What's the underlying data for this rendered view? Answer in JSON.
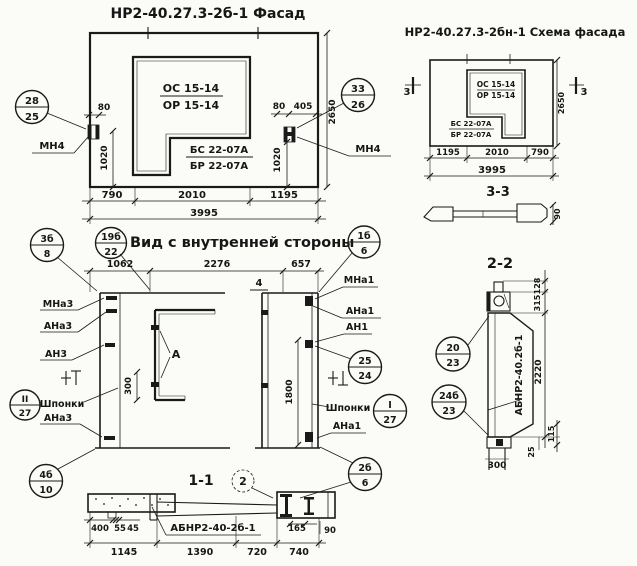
{
  "facade": {
    "title": "НР2-40.27.3-2б-1 Фасад",
    "window_mark": {
      "top": "ОС 15-14",
      "bottom": "ОР 15-14"
    },
    "panel_mark": {
      "top": "БС 22-07А",
      "bottom": "БР 22-07А"
    },
    "anchor_left": "МН4",
    "anchor_right": "МН4",
    "callout_left": {
      "top": "28",
      "bottom": "25"
    },
    "callout_right": {
      "top": "33",
      "bottom": "26"
    },
    "dims": {
      "w80_left": "80",
      "w80_right": "80",
      "w405": "405",
      "h1020_left": "1020",
      "h1020_right": "1020",
      "h2650": "2650",
      "b790": "790",
      "b2010": "2010",
      "b1195": "1195",
      "total": "3995"
    }
  },
  "schema": {
    "title": "НР2-40.27.3-2бн-1 Схема фасада",
    "window_mark": {
      "top": "ОС 15-14",
      "bottom": "ОР 15-14"
    },
    "panel_mark": {
      "top": "БС 22-07А",
      "bottom": "БР 22-07А"
    },
    "section_mark_left": "3",
    "section_mark_right": "3",
    "section_label": "3-3",
    "profile_dim": "90",
    "dims": {
      "b1195": "1195",
      "b2010": "2010",
      "b790": "790",
      "total": "3995",
      "h2650": "2650"
    }
  },
  "inner_view": {
    "title": "Вид с внутренней стороны",
    "detail_label": "А",
    "section_mark_4": "4",
    "dims": {
      "t1062": "1062",
      "t2276": "2276",
      "t657": "657",
      "v300": "300",
      "v1800": "1800"
    },
    "labels_left": {
      "mna3": "МНа3",
      "ana3_top": "АНа3",
      "an3": "АН3",
      "shponki": "Шпонки",
      "ana3_bottom": "АНа3"
    },
    "labels_right": {
      "mna1": "МНа1",
      "ana1_top": "АНа1",
      "an1": "АН1",
      "shponki": "Шпонки",
      "ana1_bottom": "АНа1"
    },
    "callouts": {
      "c3b8": {
        "top": "3б",
        "bottom": "8"
      },
      "c19b22": {
        "top": "19б",
        "bottom": "22"
      },
      "c1b6": {
        "top": "1б",
        "bottom": "6"
      },
      "c2524": {
        "top": "25",
        "bottom": "24"
      },
      "cI27": {
        "top": "I",
        "bottom": "27"
      },
      "cII27": {
        "top": "II",
        "bottom": "27"
      },
      "c2b6": {
        "top": "2б",
        "bottom": "6"
      },
      "c4b10": {
        "top": "4б",
        "bottom": "10"
      }
    }
  },
  "section_1_1": {
    "title": "1-1",
    "detail_mark": "2",
    "part_label": "АБНР2-40-2б-1",
    "dims": {
      "d400": "400",
      "d55": "55",
      "d45": "45",
      "d1145": "1145",
      "d1390": "1390",
      "d720": "720",
      "d740": "740",
      "d165": "165",
      "d90": "90"
    }
  },
  "section_2_2": {
    "title": "2-2",
    "part_label": "АБНР2-40.2б-1",
    "callout_top": {
      "top": "20",
      "bottom": "23"
    },
    "callout_bottom": {
      "top": "24б",
      "bottom": "23"
    },
    "dims": {
      "d128": "128",
      "d315": "315",
      "d2220": "2220",
      "d115": "115",
      "d25": "25",
      "d300": "300"
    }
  }
}
